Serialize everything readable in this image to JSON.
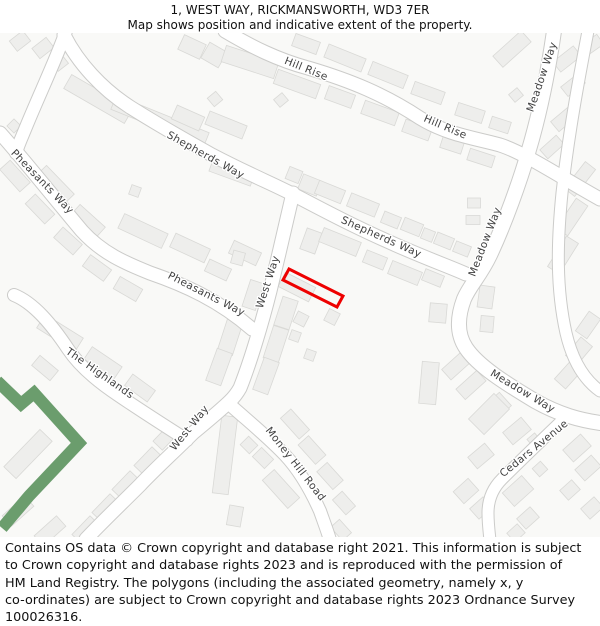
{
  "header": {
    "title": "1, WEST WAY, RICKMANSWORTH, WD3 7ER",
    "subtitle": "Map shows position and indicative extent of the property."
  },
  "footer": {
    "lines": [
      "Contains OS data © Crown copyright and database right 2021. This information is subject",
      "to Crown copyright and database rights 2023 and is reproduced with the permission of",
      "HM Land Registry. The polygons (including the associated geometry, namely x, y",
      "co-ordinates) are subject to Crown copyright and database rights 2023 Ordnance Survey",
      "100026316."
    ]
  },
  "map": {
    "colors": {
      "background": "#f9f9f7",
      "building": "#eeeeec",
      "building_outline": "#d9d9d6",
      "road_fill": "#ffffff",
      "road_casing": "#cbcbc9",
      "green": "#6b9d6d",
      "label": "#414141"
    },
    "label_style": {
      "size": 10.5
    },
    "roads": [
      {
        "name": "shepherds-way",
        "width": 13,
        "path": "M 64 2 C 78 30 102 56 130 74 C 160 93 185 107 212 122 C 252 143 276 152 302 166 C 340 186 362 197 396 212 C 430 227 448 233 466 241"
      },
      {
        "name": "pheasants-way-connector",
        "width": 12,
        "path": "M 66 -2 C 58 22 40 60 26 94 C 22 104 18 112 16 120"
      },
      {
        "name": "pheasants-way",
        "width": 13,
        "path": "M 0 100 C 25 128 55 166 82 198 C 102 220 125 230 150 240 C 185 252 220 268 252 296"
      },
      {
        "name": "hill-rise",
        "width": 13,
        "path": "M 225 -2 C 252 14 278 27 308 35 C 352 48 385 62 420 85 C 448 102 475 105 500 112 C 525 120 562 145 600 166"
      },
      {
        "name": "meadow-way",
        "width": 14,
        "path": "M 554 -2 C 548 40 540 80 528 120 C 520 148 505 190 490 222 C 480 243 470 252 464 266 C 458 282 456 300 466 315 C 478 333 505 350 535 368 C 560 382 580 387 600 390"
      },
      {
        "name": "east-side-road",
        "width": 11,
        "path": "M 588 -2 C 578 50 568 105 562 160 C 557 210 556 255 566 300 C 573 330 586 348 600 358"
      },
      {
        "name": "west-way",
        "width": 13,
        "path": "M 293 160 C 285 195 278 225 270 258 C 262 290 250 330 240 355 C 235 364 231 367 228 370 C 215 382 205 390 193 400 C 175 418 155 436 140 452 C 122 470 103 488 86 506"
      },
      {
        "name": "the-highlands",
        "width": 12,
        "path": "M 14 262 C 34 270 52 292 68 316 C 80 334 100 350 118 362 C 140 377 165 393 187 407"
      },
      {
        "name": "money-hill-road",
        "width": 12,
        "path": "M 228 370 C 248 388 268 404 285 422 C 300 438 312 460 320 478 C 325 492 328 500 330 507"
      },
      {
        "name": "cedars-avenue",
        "width": 11,
        "path": "M 568 382 C 545 404 520 428 502 446 C 492 456 488 468 488 480 C 488 490 489 498 490 507"
      }
    ],
    "labels": [
      {
        "text": "Hill Rise",
        "x": 305,
        "y": 39,
        "r": 22
      },
      {
        "text": "Hill Rise",
        "x": 444,
        "y": 97,
        "r": 23
      },
      {
        "text": "Shepherds Way",
        "x": 204,
        "y": 125,
        "r": 29
      },
      {
        "text": "Shepherds Way",
        "x": 380,
        "y": 207,
        "r": 24
      },
      {
        "text": "Pheasants Way",
        "x": 40,
        "y": 151,
        "r": 46
      },
      {
        "text": "Pheasants Way",
        "x": 205,
        "y": 264,
        "r": 27
      },
      {
        "text": "Meadow Way",
        "x": 545,
        "y": 45,
        "r": -71
      },
      {
        "text": "Meadow Way",
        "x": 488,
        "y": 210,
        "r": -69
      },
      {
        "text": "Meadow Way",
        "x": 521,
        "y": 361,
        "r": 31
      },
      {
        "text": "West Way",
        "x": 271,
        "y": 250,
        "r": -72
      },
      {
        "text": "West Way",
        "x": 192,
        "y": 397,
        "r": -51
      },
      {
        "text": "The Highlands",
        "x": 98,
        "y": 343,
        "r": 35
      },
      {
        "text": "Money Hill Road",
        "x": 293,
        "y": 433,
        "r": 52
      },
      {
        "text": "Cedars Avenue",
        "x": 536,
        "y": 418,
        "r": -39
      }
    ],
    "green_areas": [
      {
        "path": "M -3 348 L 21 371 L 34 360 L 79 410 L 29 463 L 2 495",
        "width": 12
      }
    ],
    "property": {
      "label": "1 West Way indicative extent",
      "points": "289,236 343,263 337,274 283,247",
      "color": "#ee0000",
      "stroke_width": 3
    },
    "buildings": [
      [
        192,
        14,
        24,
        16,
        25
      ],
      [
        214,
        22,
        20,
        18,
        30
      ],
      [
        250,
        29,
        55,
        17,
        18
      ],
      [
        306,
        11,
        26,
        13,
        20
      ],
      [
        215,
        66,
        11,
        11,
        -40
      ],
      [
        281,
        67,
        11,
        10,
        -40
      ],
      [
        20,
        8,
        17,
        13,
        -38
      ],
      [
        43,
        15,
        18,
        13,
        -38
      ],
      [
        60,
        30,
        13,
        11,
        -38
      ],
      [
        14,
        93,
        10,
        10,
        -45
      ],
      [
        98,
        66,
        70,
        16,
        30
      ],
      [
        160,
        88,
        100,
        15,
        22
      ],
      [
        232,
        139,
        44,
        14,
        20
      ],
      [
        188,
        85,
        30,
        15,
        24
      ],
      [
        226,
        92,
        40,
        14,
        22
      ],
      [
        345,
        25,
        40,
        14,
        22
      ],
      [
        388,
        42,
        38,
        14,
        22
      ],
      [
        428,
        60,
        32,
        13,
        20
      ],
      [
        470,
        80,
        28,
        13,
        18
      ],
      [
        500,
        92,
        20,
        12,
        18
      ],
      [
        297,
        51,
        45,
        15,
        20
      ],
      [
        340,
        64,
        28,
        14,
        20
      ],
      [
        380,
        80,
        36,
        14,
        20
      ],
      [
        417,
        97,
        28,
        13,
        20
      ],
      [
        452,
        112,
        22,
        12,
        18
      ],
      [
        481,
        125,
        26,
        12,
        18
      ],
      [
        512,
        16,
        38,
        15,
        -42
      ],
      [
        567,
        26,
        26,
        13,
        -38
      ],
      [
        573,
        52,
        22,
        12,
        -38
      ],
      [
        564,
        86,
        24,
        13,
        -40
      ],
      [
        552,
        114,
        22,
        12,
        -42
      ],
      [
        592,
        12,
        20,
        12,
        -35
      ],
      [
        516,
        62,
        11,
        10,
        -40
      ],
      [
        580,
        146,
        34,
        13,
        -52
      ],
      [
        572,
        184,
        36,
        14,
        -56
      ],
      [
        563,
        222,
        36,
        14,
        -58
      ],
      [
        588,
        292,
        24,
        14,
        -55
      ],
      [
        579,
        318,
        24,
        15,
        -50
      ],
      [
        568,
        342,
        24,
        15,
        -48
      ],
      [
        474,
        170,
        13,
        10,
        0
      ],
      [
        473,
        187,
        14,
        9,
        0
      ],
      [
        486,
        264,
        15,
        22,
        8
      ],
      [
        487,
        291,
        13,
        16,
        5
      ],
      [
        294,
        142,
        14,
        13,
        22
      ],
      [
        310,
        152,
        20,
        16,
        22
      ],
      [
        330,
        159,
        28,
        14,
        22
      ],
      [
        363,
        172,
        30,
        14,
        22
      ],
      [
        391,
        187,
        18,
        12,
        22
      ],
      [
        412,
        194,
        20,
        13,
        22
      ],
      [
        428,
        202,
        12,
        11,
        22
      ],
      [
        444,
        208,
        18,
        12,
        22
      ],
      [
        462,
        216,
        16,
        11,
        22
      ],
      [
        311,
        208,
        16,
        22,
        20
      ],
      [
        340,
        209,
        40,
        15,
        22
      ],
      [
        375,
        227,
        22,
        13,
        22
      ],
      [
        405,
        240,
        32,
        14,
        22
      ],
      [
        433,
        245,
        20,
        12,
        22
      ],
      [
        55,
        152,
        40,
        15,
        46
      ],
      [
        88,
        188,
        34,
        14,
        42
      ],
      [
        143,
        198,
        48,
        16,
        25
      ],
      [
        190,
        215,
        38,
        15,
        25
      ],
      [
        245,
        220,
        30,
        14,
        25
      ],
      [
        218,
        237,
        24,
        13,
        25
      ],
      [
        253,
        262,
        14,
        28,
        18
      ],
      [
        135,
        158,
        10,
        10,
        20
      ],
      [
        15,
        143,
        30,
        14,
        48
      ],
      [
        40,
        176,
        28,
        14,
        46
      ],
      [
        68,
        208,
        26,
        14,
        42
      ],
      [
        97,
        235,
        26,
        14,
        36
      ],
      [
        128,
        256,
        26,
        14,
        30
      ],
      [
        297,
        254,
        34,
        16,
        27
      ],
      [
        301,
        286,
        12,
        12,
        27
      ],
      [
        332,
        284,
        12,
        13,
        27
      ],
      [
        295,
        303,
        10,
        10,
        20
      ],
      [
        310,
        322,
        10,
        10,
        20
      ],
      [
        238,
        225,
        12,
        13,
        15
      ],
      [
        286,
        280,
        16,
        30,
        18
      ],
      [
        276,
        311,
        16,
        34,
        18
      ],
      [
        266,
        343,
        16,
        34,
        20
      ],
      [
        230,
        304,
        16,
        34,
        18
      ],
      [
        219,
        334,
        16,
        34,
        20
      ],
      [
        438,
        280,
        17,
        19,
        5
      ],
      [
        429,
        350,
        17,
        42,
        5
      ],
      [
        456,
        333,
        26,
        14,
        -42
      ],
      [
        471,
        352,
        28,
        14,
        -42
      ],
      [
        492,
        378,
        36,
        18,
        -42
      ],
      [
        517,
        398,
        24,
        16,
        -40
      ],
      [
        534,
        407,
        10,
        10,
        -40
      ],
      [
        60,
        300,
        45,
        16,
        32
      ],
      [
        103,
        330,
        36,
        15,
        34
      ],
      [
        140,
        355,
        28,
        14,
        36
      ],
      [
        45,
        335,
        24,
        13,
        40
      ],
      [
        28,
        421,
        52,
        17,
        -46
      ],
      [
        18,
        478,
        30,
        14,
        -42
      ],
      [
        50,
        498,
        30,
        14,
        -42
      ],
      [
        166,
        404,
        24,
        13,
        -46
      ],
      [
        148,
        428,
        26,
        14,
        -46
      ],
      [
        126,
        452,
        26,
        14,
        -46
      ],
      [
        106,
        475,
        26,
        14,
        -46
      ],
      [
        86,
        497,
        26,
        14,
        -46
      ],
      [
        225,
        422,
        16,
        78,
        7
      ],
      [
        249,
        412,
        13,
        12,
        45
      ],
      [
        263,
        425,
        17,
        13,
        45
      ],
      [
        281,
        456,
        38,
        16,
        48
      ],
      [
        235,
        483,
        14,
        20,
        10
      ],
      [
        295,
        391,
        28,
        14,
        48
      ],
      [
        312,
        417,
        26,
        14,
        48
      ],
      [
        330,
        443,
        24,
        14,
        48
      ],
      [
        344,
        470,
        20,
        13,
        48
      ],
      [
        341,
        497,
        18,
        12,
        48
      ],
      [
        489,
        381,
        36,
        22,
        -45
      ],
      [
        481,
        423,
        22,
        15,
        -40
      ],
      [
        466,
        458,
        20,
        16,
        -42
      ],
      [
        481,
        475,
        18,
        14,
        -42
      ],
      [
        577,
        415,
        24,
        16,
        -42
      ],
      [
        588,
        435,
        22,
        15,
        -42
      ],
      [
        570,
        457,
        16,
        13,
        -42
      ],
      [
        592,
        475,
        18,
        14,
        -42
      ],
      [
        518,
        458,
        26,
        18,
        -42
      ],
      [
        528,
        485,
        18,
        14,
        -42
      ],
      [
        540,
        436,
        11,
        11,
        -42
      ],
      [
        516,
        500,
        14,
        12,
        -42
      ]
    ]
  }
}
